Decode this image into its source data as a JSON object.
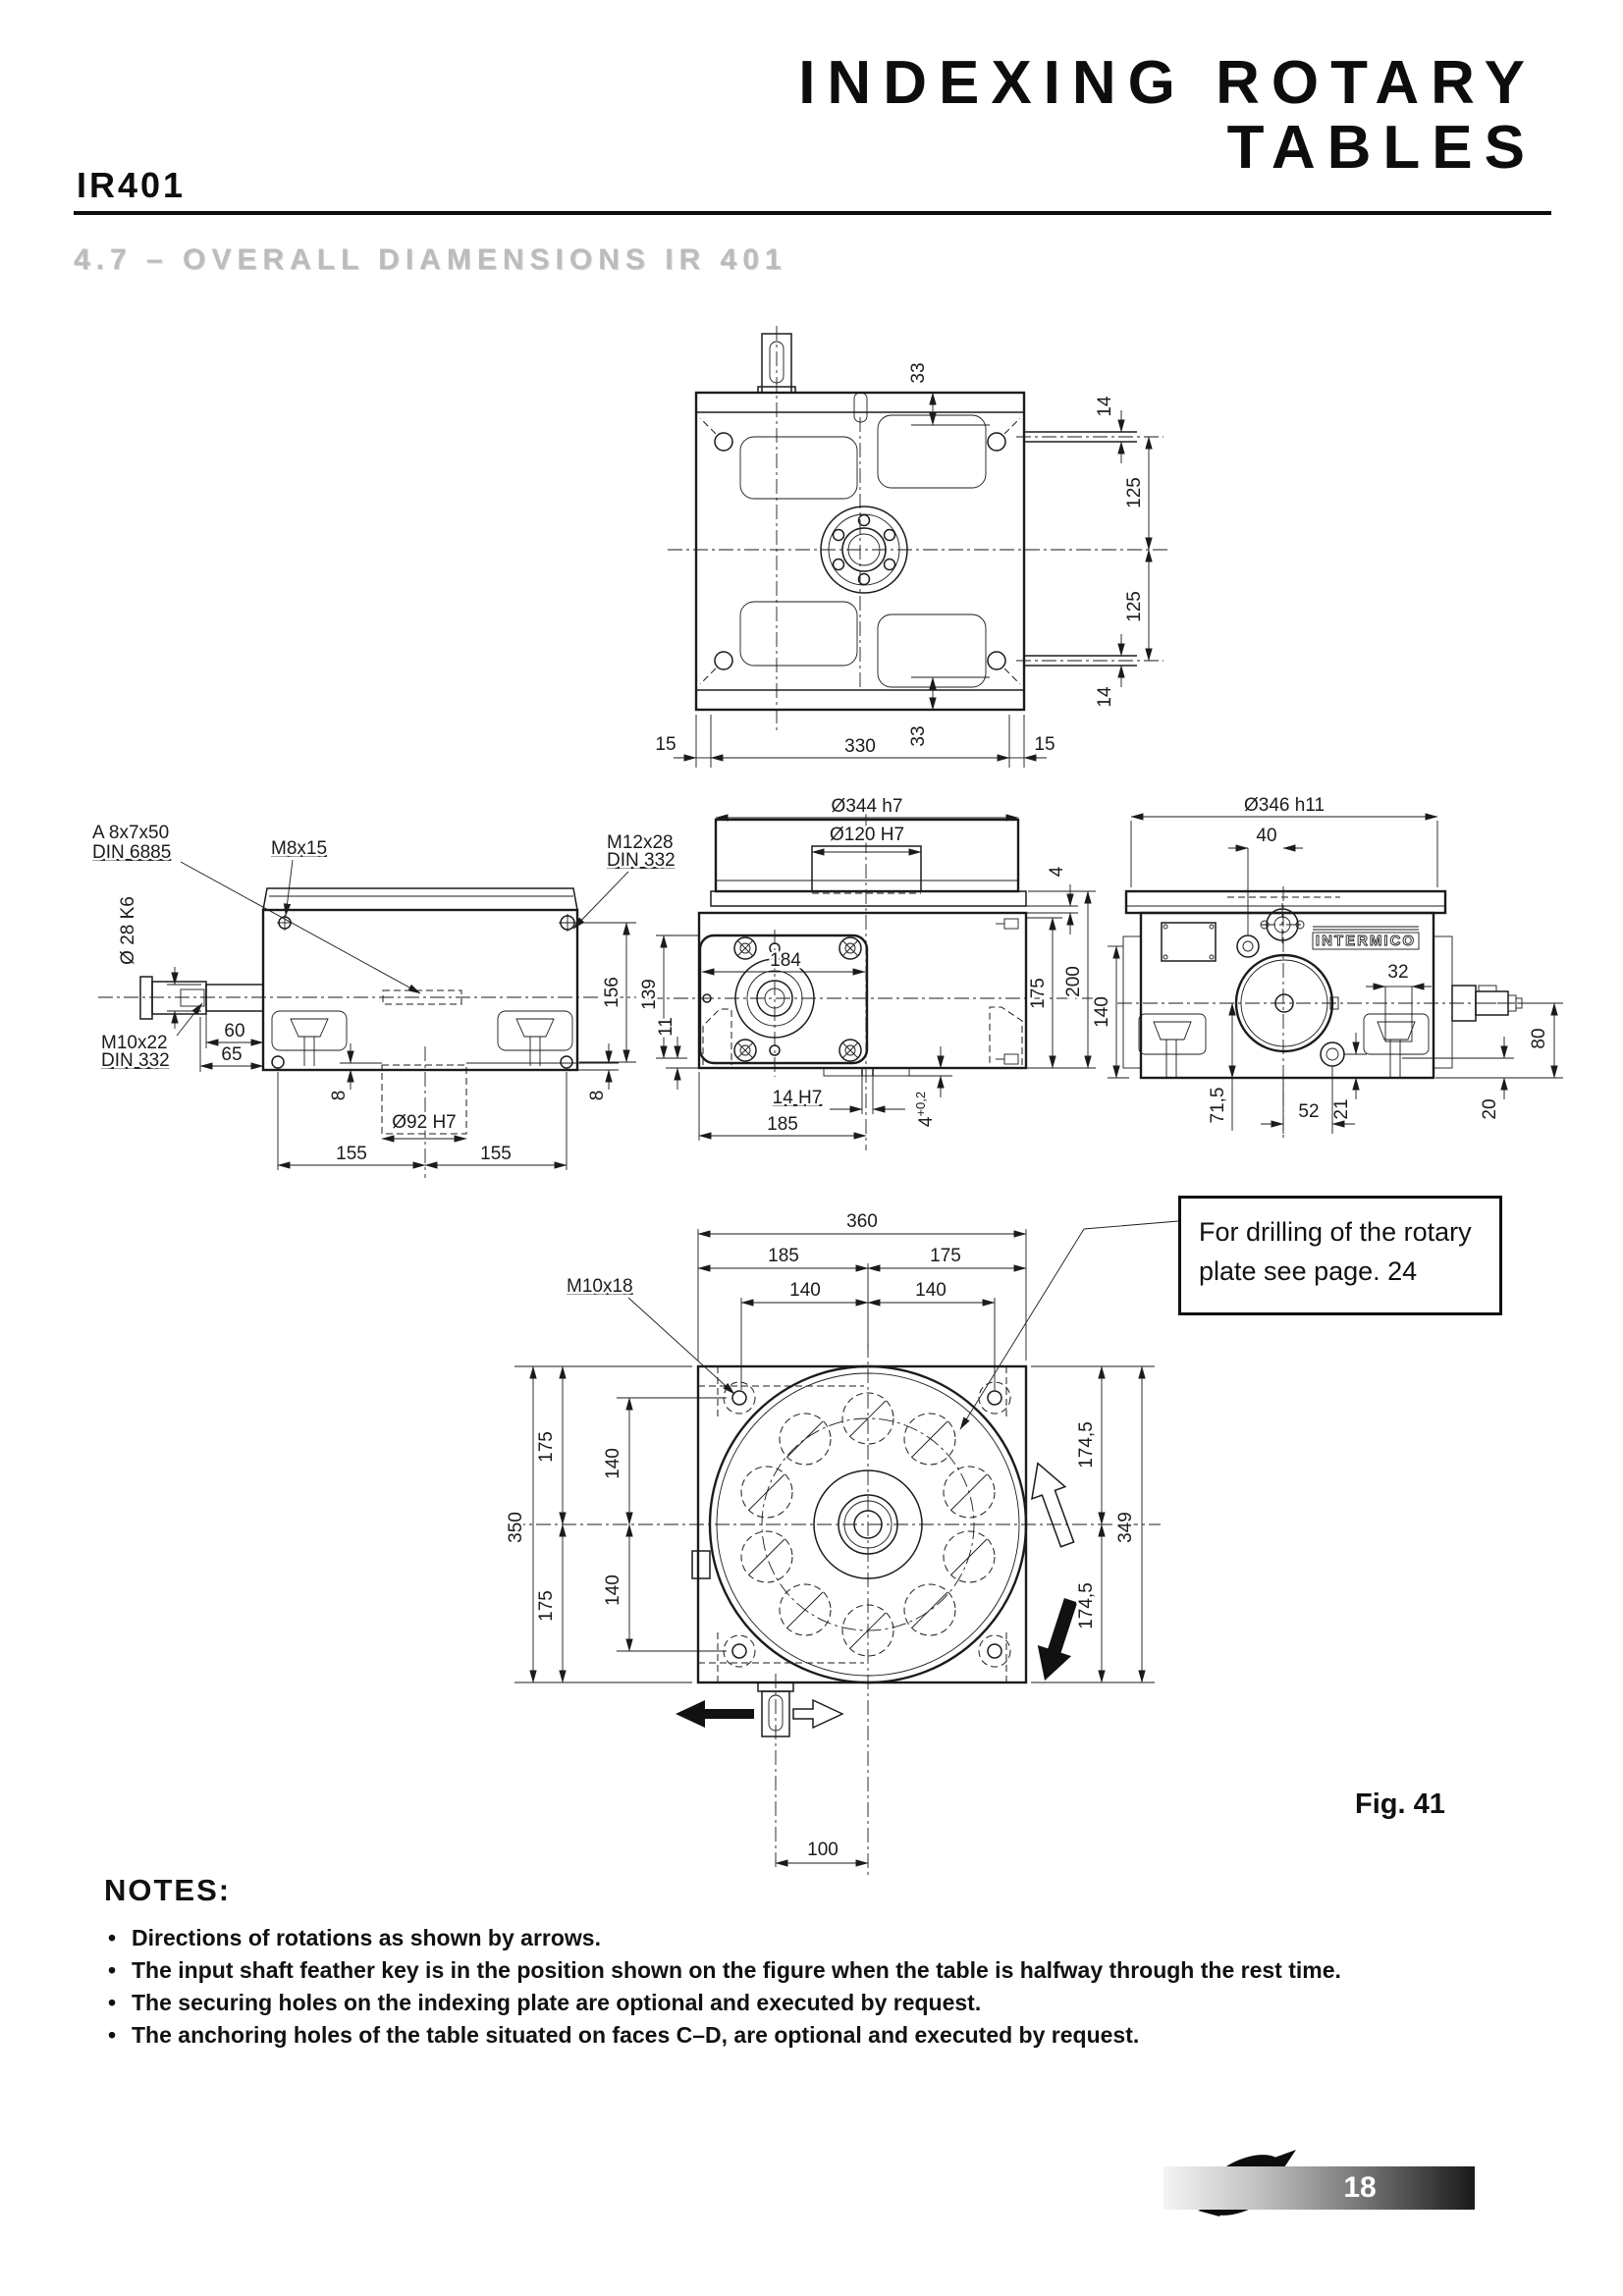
{
  "header": {
    "title_line1": "INDEXING ROTARY",
    "title_line2": "TABLES",
    "model": "IR401",
    "section": "4.7 – OVERALL DIAMENSIONS IR 401"
  },
  "figure": {
    "label": "Fig. 41",
    "callout": "For drilling of the rotary plate see page. 24"
  },
  "notes": {
    "heading": "NOTES:",
    "items": [
      "Directions of rotations as shown by arrows.",
      "The input shaft feather key is in the position shown on the figure when the table is halfway through the rest time.",
      "The securing holes on the indexing plate are optional and executed by request.",
      "The anchoring holes of the table situated on faces C–D, are optional and executed by request."
    ]
  },
  "footer": {
    "page_number": "18"
  },
  "top_view": {
    "dims": {
      "slot_offset_top": "33",
      "pin_top": "14",
      "center_upper": "125",
      "center_lower": "125",
      "pin_bottom": "14",
      "edge_left": "15",
      "slot_offset_bottom": "33",
      "body_width": "330",
      "edge_right": "15"
    }
  },
  "side_view": {
    "labels": {
      "key": "A 8x7x50",
      "key_std": "DIN 6885",
      "tap_top": "M8x15",
      "tap_face": "M12x28",
      "tap_face_std": "DIN 332",
      "shaft_dia": "Ø 28 K6",
      "tap_shaft": "M10x22",
      "tap_shaft_std": "DIN 332"
    },
    "dims": {
      "shaft_step": "60",
      "shaft_len": "65",
      "face_height": "156",
      "recess_l": "8",
      "recess_r": "8",
      "spigot_dia": "Ø92 H7",
      "bolt_l": "155",
      "bolt_r": "155"
    }
  },
  "front_view": {
    "dims": {
      "plate_dia": "Ø344 h7",
      "bore_dia": "Ø120 H7",
      "plate_lip": "4",
      "face_w": "184",
      "face_h": "139",
      "step": "11",
      "key_slot": "14 H7",
      "half_w": "185",
      "slot_depth": "4",
      "slot_tol": "+0,2",
      "h_inner": "175",
      "h_total": "200"
    }
  },
  "end_view": {
    "logo": "INTERMICO",
    "dims": {
      "plate_dia": "Ø346 h11",
      "hole_offset": "40",
      "h_left": "140",
      "block_w": "32",
      "shaft_h": "80",
      "axis_bottom": "71,5",
      "bolt_x": "52",
      "bolt_y": "21",
      "foot": "20"
    }
  },
  "plate_view": {
    "labels": {
      "tap": "M10x18"
    },
    "dims": {
      "w": "360",
      "w_left": "185",
      "w_right": "175",
      "hole_wl": "140",
      "hole_wr": "140",
      "h": "350",
      "h_upper": "175",
      "hole_hu": "140",
      "h_lower": "175",
      "hole_hl": "140",
      "r_upper": "174,5",
      "dia": "349",
      "r_lower": "174,5",
      "shaft_x": "100"
    }
  }
}
